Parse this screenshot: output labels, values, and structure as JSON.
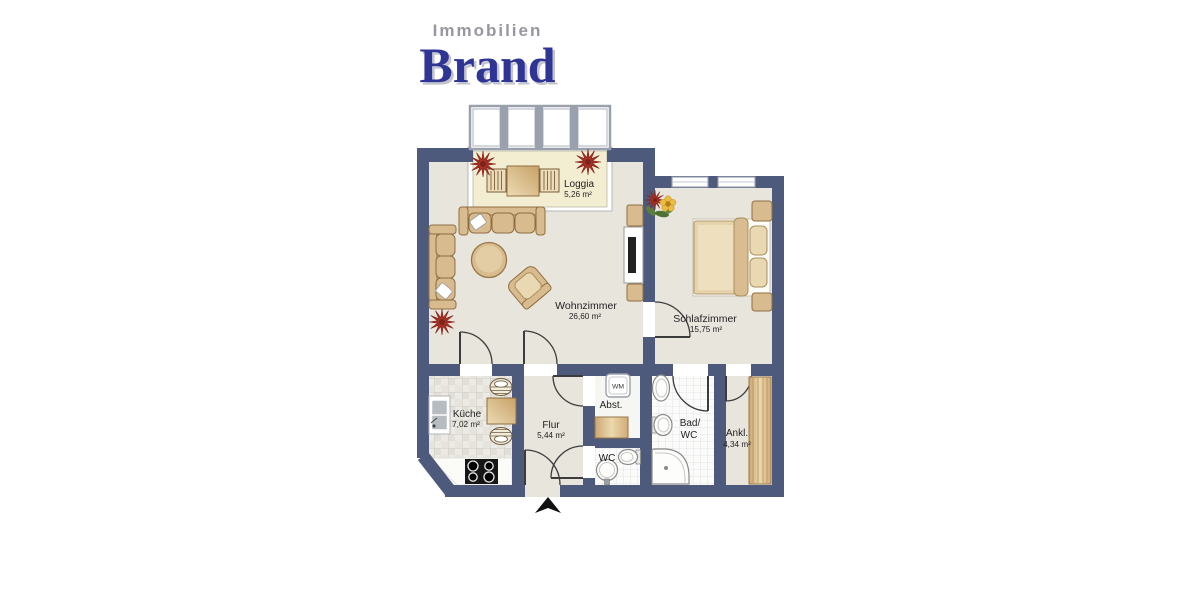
{
  "logo": {
    "top": "Immobilien",
    "main": "Brand"
  },
  "rooms": {
    "loggia": {
      "name": "Loggia",
      "area": "5,26 m²"
    },
    "wohnzimmer": {
      "name": "Wohnzimmer",
      "area": "26,60 m²"
    },
    "schlafzimmer": {
      "name": "Schlafzimmer",
      "area": "15,75 m²"
    },
    "kueche": {
      "name": "Küche",
      "area": "7,02 m²"
    },
    "flur": {
      "name": "Flur",
      "area": "5,44 m²"
    },
    "abstellraum": {
      "name": "Abst."
    },
    "bad_wc": {
      "name_line1": "Bad/",
      "name_line2": "WC"
    },
    "wc": {
      "name": "WC"
    },
    "ankleide": {
      "name": "Ankl.",
      "area": "4,34 m²"
    }
  },
  "appliances": {
    "washing_machine_label": "WM"
  },
  "colors": {
    "wall": "#4d5a7c",
    "floor": "#e8e5dd",
    "loggia_floor": "#f3edd2",
    "furniture_tan": "#d8bb8e",
    "plant_red": "#a93327",
    "logo_gray": "#97979f",
    "logo_blue": "#2f3594"
  }
}
